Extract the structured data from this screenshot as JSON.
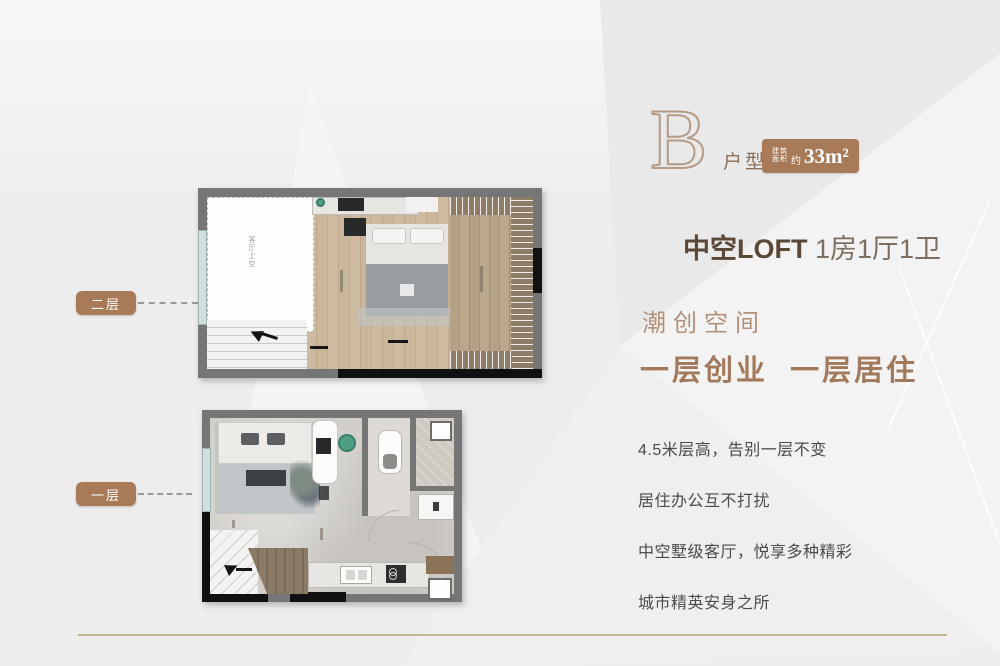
{
  "header": {
    "unit_letter": "B",
    "unit_type_label": "户型",
    "area_badge": {
      "stacked_top": "建筑",
      "stacked_bottom": "面积",
      "approx": "约",
      "value": "33m²"
    },
    "headline_bold": "中空LOFT",
    "headline_rest": " 1房1厅1卫"
  },
  "slogan": {
    "line1": "潮创空间",
    "line2": "一层创业  一层居住"
  },
  "features": [
    "4.5米层高，告别一层不变",
    "居住办公互不打扰",
    "中空墅级客厅，悦享多种精彩",
    "城市精英安身之所"
  ],
  "floorplans": {
    "upper": {
      "label": "二层",
      "void_label": "客厅上空"
    },
    "lower": {
      "label": "一层"
    }
  },
  "colors": {
    "accent_brown": "#a87a58",
    "headline_dark": "#5a4736",
    "slogan_light": "#b29079",
    "slogan_bold": "#a3795c",
    "feature_text": "#4b4b4b",
    "outline_letter": "#b59a85",
    "wall_gray": "#767676",
    "gold_line": "#c6b394"
  }
}
